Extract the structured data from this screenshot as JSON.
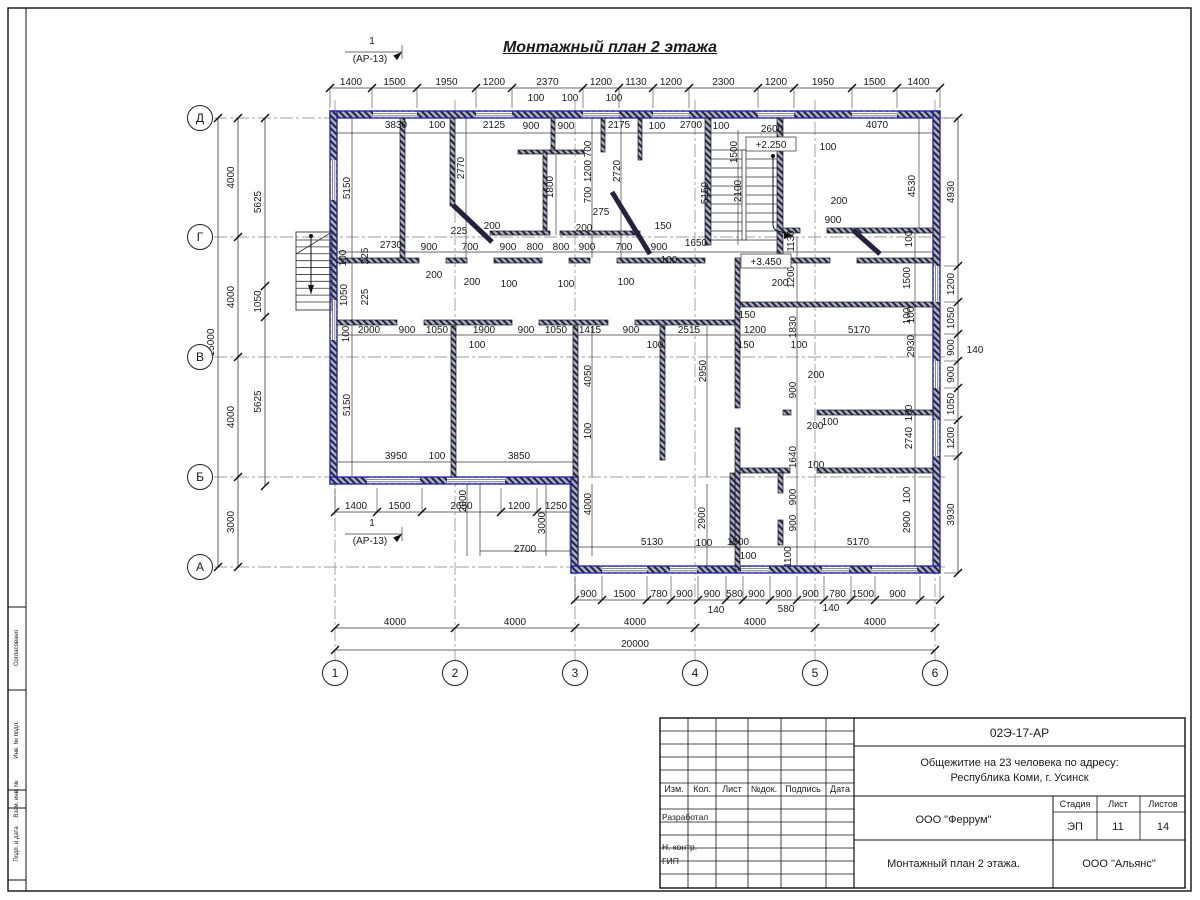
{
  "title": "Монтажный план 2 этажа",
  "section_mark": {
    "num": "1",
    "ref": "(АР-13)"
  },
  "axes": {
    "row_labels": [
      "Д",
      "Г",
      "В",
      "Б",
      "А"
    ],
    "rows": [
      118,
      237,
      357,
      477,
      567
    ],
    "col_labels": [
      "1",
      "2",
      "3",
      "4",
      "5",
      "6"
    ],
    "cols": [
      335,
      455,
      575,
      695,
      815,
      935
    ]
  },
  "levels": [
    {
      "t": "+2.250",
      "x": 771,
      "y": 147
    },
    {
      "t": "+3.450",
      "x": 766,
      "y": 264
    }
  ],
  "drawing": {
    "colors": {
      "wall_blue": "#1f1fae",
      "ink": "#1a1a1a",
      "dim": "#3a3a3a",
      "axis": "#808080"
    },
    "chains": [
      {
        "d": "h",
        "p": 88,
        "ext": 20,
        "pts": [
          330,
          372,
          417,
          476,
          512,
          583,
          619,
          653,
          689,
          758,
          794,
          852,
          897,
          940
        ],
        "labels": [
          "1400",
          "1500",
          "1950",
          "1200",
          "2370",
          "1200",
          "1130",
          "1200",
          "2300",
          "1200",
          "1950",
          "1500",
          "1400"
        ]
      },
      {
        "d": "h",
        "p": 600,
        "ext": -24,
        "pts": [
          575,
          602,
          647,
          671,
          698,
          726,
          743,
          770,
          797,
          824,
          851,
          875,
          920,
          940
        ],
        "labels": [
          "900",
          "1500",
          "780",
          "900",
          "900",
          "580",
          "900",
          "900",
          "900",
          "780",
          "1500",
          "900",
          ""
        ]
      },
      {
        "d": "h",
        "p": 628,
        "ext": 0,
        "pts": [
          335,
          455,
          575,
          695,
          815,
          935
        ],
        "labels": [
          "4000",
          "4000",
          "4000",
          "4000",
          "4000"
        ]
      },
      {
        "d": "h",
        "p": 650,
        "ext": 0,
        "pts": [
          335,
          935
        ],
        "labels": [
          "20000"
        ]
      },
      {
        "d": "h",
        "p": 512,
        "ext": -24,
        "pts": [
          335,
          377,
          422,
          501,
          537,
          575
        ],
        "labels": [
          "1400",
          "1500",
          "2650",
          "1200",
          "1250"
        ]
      },
      {
        "d": "v",
        "p": 238,
        "ext": 0,
        "pts": [
          118,
          237,
          357,
          477,
          567
        ],
        "labels": [
          "4000",
          "4000",
          "4000",
          "3000"
        ]
      },
      {
        "d": "v",
        "p": 218,
        "ext": 0,
        "pts": [
          118,
          567
        ],
        "labels": [
          "15000"
        ]
      },
      {
        "d": "v",
        "p": 265,
        "ext": 0,
        "pts": [
          118,
          286,
          317,
          486
        ],
        "labels": [
          "5625",
          "1050",
          "5625"
        ]
      },
      {
        "d": "v",
        "p": 958,
        "ext": -14,
        "pts": [
          118,
          266,
          302,
          334,
          361,
          388,
          420,
          456,
          573
        ],
        "labels": [
          "4930",
          "1200",
          "1050",
          "900",
          "900",
          "1050",
          "1200",
          "3930"
        ]
      }
    ],
    "texts": [
      [
        "1",
        372,
        44
      ],
      [
        "(АР-13)",
        370,
        62
      ],
      [
        "1",
        372,
        526
      ],
      [
        "(АР-13)",
        370,
        544
      ],
      [
        "100",
        536,
        101
      ],
      [
        "100",
        570,
        101
      ],
      [
        "100",
        614,
        101
      ],
      [
        "3830",
        396,
        128
      ],
      [
        "100",
        437,
        128
      ],
      [
        "2125",
        494,
        128
      ],
      [
        "900",
        531,
        129
      ],
      [
        "900",
        566,
        129
      ],
      [
        "2175",
        619,
        128
      ],
      [
        "100",
        657,
        129
      ],
      [
        "2700",
        691,
        128
      ],
      [
        "100",
        721,
        129
      ],
      [
        "2600",
        772,
        132
      ],
      [
        "4070",
        877,
        128
      ],
      [
        "5150",
        350,
        188,
        "r"
      ],
      [
        "2770",
        464,
        168,
        "r"
      ],
      [
        "1800",
        553,
        187,
        "r"
      ],
      [
        "700",
        591,
        149,
        "r"
      ],
      [
        "1200",
        591,
        171,
        "r"
      ],
      [
        "700",
        591,
        195,
        "r"
      ],
      [
        "2720",
        620,
        171,
        "r"
      ],
      [
        "5150",
        708,
        193,
        "r"
      ],
      [
        "1500",
        737,
        152,
        "r"
      ],
      [
        "2100",
        741,
        191,
        "r"
      ],
      [
        "4530",
        915,
        186,
        "r"
      ],
      [
        "275",
        601,
        215
      ],
      [
        "100",
        828,
        150
      ],
      [
        "200",
        839,
        204
      ],
      [
        "900",
        833,
        223
      ],
      [
        "1130",
        794,
        241,
        "r"
      ],
      [
        "1200",
        794,
        277,
        "r"
      ],
      [
        "200",
        780,
        286
      ],
      [
        "100",
        912,
        239,
        "r"
      ],
      [
        "1500",
        910,
        278,
        "r"
      ],
      [
        "100",
        910,
        316,
        "r"
      ],
      [
        "2730",
        391,
        248
      ],
      [
        "900",
        429,
        250
      ],
      [
        "700",
        470,
        250
      ],
      [
        "900",
        508,
        250
      ],
      [
        "800",
        535,
        250
      ],
      [
        "800",
        561,
        250
      ],
      [
        "900",
        587,
        250
      ],
      [
        "700",
        624,
        250
      ],
      [
        "900",
        659,
        250
      ],
      [
        "100",
        669,
        263
      ],
      [
        "1650",
        696,
        246
      ],
      [
        "225",
        459,
        234
      ],
      [
        "200",
        492,
        229
      ],
      [
        "200",
        584,
        231
      ],
      [
        "150",
        663,
        229
      ],
      [
        "100",
        346,
        258,
        "r"
      ],
      [
        "225",
        368,
        256,
        "r"
      ],
      [
        "1050",
        347,
        295,
        "r"
      ],
      [
        "225",
        368,
        297,
        "r"
      ],
      [
        "200",
        434,
        278
      ],
      [
        "200",
        472,
        285
      ],
      [
        "100",
        509,
        287
      ],
      [
        "100",
        566,
        287
      ],
      [
        "100",
        626,
        285
      ],
      [
        "2000",
        369,
        333
      ],
      [
        "900",
        407,
        333
      ],
      [
        "1050",
        437,
        333
      ],
      [
        "1900",
        484,
        333
      ],
      [
        "900",
        526,
        333
      ],
      [
        "1050",
        556,
        333
      ],
      [
        "1415",
        590,
        333
      ],
      [
        "900",
        631,
        333
      ],
      [
        "100",
        655,
        348
      ],
      [
        "2515",
        689,
        333
      ],
      [
        "150",
        747,
        318
      ],
      [
        "1200",
        755,
        333
      ],
      [
        "150",
        746,
        348
      ],
      [
        "1830",
        796,
        327,
        "r"
      ],
      [
        "100",
        799,
        348
      ],
      [
        "5170",
        859,
        333
      ],
      [
        "100",
        477,
        348
      ],
      [
        "100",
        349,
        334,
        "r"
      ],
      [
        "5150",
        350,
        405,
        "r"
      ],
      [
        "2930",
        914,
        346,
        "r"
      ],
      [
        "100",
        914,
        315,
        "r"
      ],
      [
        "4050",
        591,
        376,
        "r"
      ],
      [
        "100",
        591,
        431,
        "r"
      ],
      [
        "2950",
        706,
        371,
        "r"
      ],
      [
        "900",
        796,
        390,
        "r"
      ],
      [
        "200",
        816,
        378
      ],
      [
        "200",
        815,
        429
      ],
      [
        "100",
        830,
        425
      ],
      [
        "1640",
        796,
        457,
        "r"
      ],
      [
        "100",
        816,
        468
      ],
      [
        "900",
        796,
        497,
        "r"
      ],
      [
        "2740",
        912,
        438,
        "r"
      ],
      [
        "100",
        912,
        413,
        "r"
      ],
      [
        "3950",
        396,
        459
      ],
      [
        "100",
        437,
        459
      ],
      [
        "3850",
        519,
        459
      ],
      [
        "2000",
        466,
        501,
        "r"
      ],
      [
        "3000",
        545,
        523,
        "r"
      ],
      [
        "4000",
        591,
        504,
        "r"
      ],
      [
        "2700",
        525,
        552
      ],
      [
        "5130",
        652,
        545
      ],
      [
        "100",
        704,
        546
      ],
      [
        "1500",
        738,
        545
      ],
      [
        "100",
        748,
        559
      ],
      [
        "5170",
        858,
        545
      ],
      [
        "2900",
        705,
        518,
        "r"
      ],
      [
        "1100",
        791,
        557,
        "r"
      ],
      [
        "900",
        796,
        523,
        "r"
      ],
      [
        "2900",
        910,
        522,
        "r"
      ],
      [
        "100",
        910,
        495,
        "r"
      ],
      [
        "140",
        975,
        353
      ],
      [
        "140",
        716,
        613
      ],
      [
        "580",
        786,
        612
      ],
      [
        "140",
        831,
        611
      ]
    ],
    "lines": [
      [
        337,
        133,
        933,
        133
      ],
      [
        337,
        252,
        933,
        252
      ],
      [
        337,
        335,
        933,
        335
      ],
      [
        337,
        462,
        577,
        462
      ],
      [
        578,
        547,
        933,
        547
      ],
      [
        352,
        118,
        352,
        477
      ],
      [
        466,
        118,
        466,
        258
      ],
      [
        556,
        150,
        556,
        235
      ],
      [
        592,
        118,
        592,
        258
      ],
      [
        592,
        326,
        592,
        477
      ],
      [
        592,
        484,
        592,
        556
      ],
      [
        621,
        118,
        621,
        258
      ],
      [
        709,
        118,
        709,
        245
      ],
      [
        738,
        130,
        738,
        245
      ],
      [
        797,
        237,
        797,
        566
      ],
      [
        915,
        228,
        915,
        566
      ],
      [
        919,
        118,
        919,
        228
      ],
      [
        467,
        484,
        467,
        556
      ],
      [
        546,
        484,
        546,
        556
      ],
      [
        707,
        326,
        707,
        477
      ],
      [
        707,
        484,
        707,
        566
      ],
      [
        480,
        484,
        480,
        556
      ],
      [
        570,
        484,
        570,
        556
      ],
      [
        480,
        551,
        570,
        551
      ],
      [
        345,
        52,
        402,
        52
      ],
      [
        402,
        45,
        402,
        59
      ],
      [
        345,
        534,
        402,
        534
      ],
      [
        402,
        527,
        402,
        541
      ]
    ],
    "walls_ext": [
      [
        330,
        111,
        610,
        7
      ],
      [
        330,
        111,
        7,
        373
      ],
      [
        933,
        111,
        7,
        462
      ],
      [
        330,
        477,
        248,
        7
      ],
      [
        571,
        477,
        7,
        96
      ],
      [
        571,
        566,
        369,
        7
      ]
    ],
    "windows_h": [
      [
        373,
        111,
        44
      ],
      [
        476,
        111,
        36
      ],
      [
        583,
        111,
        36
      ],
      [
        653,
        111,
        36
      ],
      [
        758,
        111,
        36
      ],
      [
        852,
        111,
        45
      ],
      [
        367,
        477,
        53
      ],
      [
        447,
        477,
        58
      ],
      [
        602,
        566,
        45
      ],
      [
        670,
        566,
        27
      ],
      [
        741,
        566,
        28
      ],
      [
        822,
        566,
        27
      ],
      [
        872,
        566,
        45
      ]
    ],
    "windows_v": [
      [
        330,
        160,
        40
      ],
      [
        330,
        300,
        40
      ],
      [
        933,
        266,
        36
      ],
      [
        933,
        361,
        27
      ],
      [
        933,
        420,
        36
      ]
    ],
    "walls_int": [
      [
        400,
        118,
        5,
        140
      ],
      [
        450,
        118,
        5,
        88
      ],
      [
        551,
        118,
        4,
        34
      ],
      [
        601,
        118,
        4,
        34
      ],
      [
        638,
        118,
        4,
        42
      ],
      [
        518,
        150,
        66,
        4
      ],
      [
        543,
        152,
        4,
        82
      ],
      [
        490,
        231,
        60,
        4
      ],
      [
        560,
        231,
        80,
        4
      ],
      [
        705,
        118,
        6,
        127
      ],
      [
        777,
        118,
        6,
        140
      ],
      [
        337,
        258,
        82,
        5
      ],
      [
        446,
        258,
        21,
        5
      ],
      [
        494,
        258,
        48,
        5
      ],
      [
        569,
        258,
        21,
        5
      ],
      [
        617,
        258,
        50,
        5
      ],
      [
        667,
        258,
        38,
        5
      ],
      [
        782,
        258,
        48,
        5
      ],
      [
        857,
        258,
        76,
        5
      ],
      [
        337,
        320,
        60,
        5
      ],
      [
        424,
        320,
        88,
        5
      ],
      [
        539,
        320,
        69,
        5
      ],
      [
        635,
        320,
        100,
        5
      ],
      [
        451,
        326,
        5,
        151
      ],
      [
        573,
        326,
        5,
        151
      ],
      [
        660,
        326,
        5,
        134
      ],
      [
        783,
        228,
        17,
        5
      ],
      [
        827,
        228,
        106,
        5
      ],
      [
        740,
        302,
        193,
        5
      ],
      [
        735,
        258,
        5,
        150
      ],
      [
        735,
        428,
        5,
        142
      ],
      [
        783,
        410,
        8,
        5
      ],
      [
        817,
        410,
        116,
        5
      ],
      [
        740,
        468,
        50,
        5
      ],
      [
        817,
        468,
        116,
        5
      ],
      [
        730,
        473,
        5,
        72
      ],
      [
        778,
        473,
        5,
        20
      ],
      [
        778,
        520,
        5,
        25
      ]
    ],
    "walls_diag": [
      [
        453,
        205,
        492,
        242
      ],
      [
        612,
        192,
        650,
        254
      ],
      [
        853,
        230,
        880,
        254
      ]
    ],
    "stair_main": {
      "x1": 711,
      "x2": 777,
      "y1": 150,
      "y2": 240,
      "steps": 10,
      "stringer": [
        742,
        150,
        4,
        90
      ],
      "dot": [
        773,
        156
      ],
      "rail": [
        773,
        156,
        773,
        224
      ],
      "curve": "M773,224 C773,234 783,230 793,236"
    },
    "stair_ext": {
      "rect": [
        296,
        232,
        36,
        78
      ],
      "x1": 296,
      "x2": 332,
      "ys": 240,
      "ye": 302,
      "steps": 9,
      "diag": [
        296,
        254,
        332,
        232
      ],
      "dot": [
        311,
        236
      ],
      "line": [
        311,
        236,
        311,
        294
      ]
    },
    "arrows": [
      [
        793,
        236,
        0
      ],
      [
        311,
        294,
        90
      ],
      [
        402,
        52,
        -40
      ],
      [
        402,
        534,
        -40
      ]
    ]
  },
  "title_block": {
    "doc_number": "02Э-17-АР",
    "project_line1": "Общежитие на 23 человека по адресу:",
    "project_line2": "Республика Коми, г. Усинск",
    "columns": [
      "Изм.",
      "Кол.",
      "Лист",
      "№док.",
      "Подпись",
      "Дата"
    ],
    "roles": [
      "Разработал",
      "Н. контр.",
      "ГИП"
    ],
    "org1": "ООО \"Феррум\"",
    "sheet_title": "Монтажный план 2 этажа.",
    "org2": "ООО \"Альянс\"",
    "stage_label": "Стадия",
    "sheet_label": "Лист",
    "sheets_label": "Листов",
    "stage": "ЭП",
    "sheet": "11",
    "sheets": "14"
  },
  "side_stamp": [
    "Согласовано",
    "Инв. № подл.",
    "Взам. инв. №",
    "Подп. и дата"
  ]
}
